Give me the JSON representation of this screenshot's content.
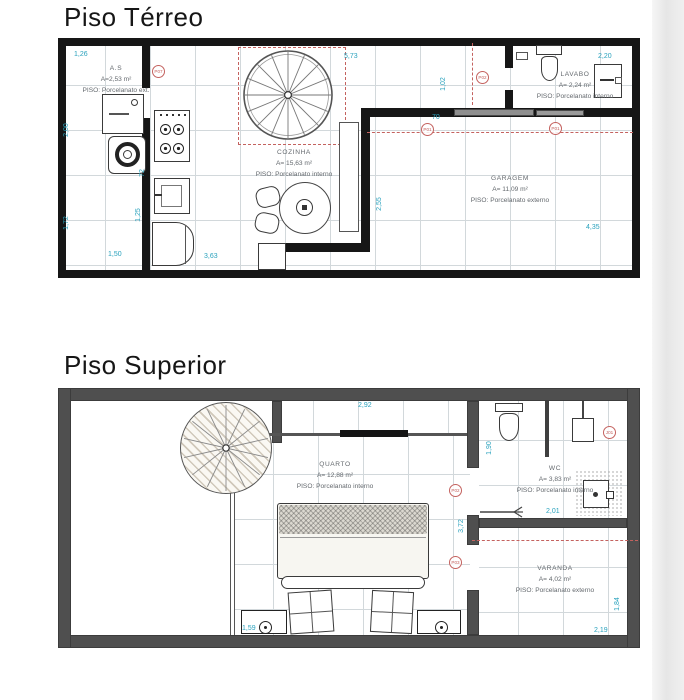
{
  "floors": {
    "terreo": {
      "title": "Piso Térreo",
      "rooms": {
        "as": {
          "name": "A.S",
          "area": "A=2,53 m²",
          "piso": "PISO: Porcelanato ext."
        },
        "cozinha": {
          "name": "COZINHA",
          "area": "A= 15,63 m²",
          "piso": "PISO: Porcelanato interno"
        },
        "lavabo": {
          "name": "LAVABO",
          "area": "A= 2,24 m²",
          "piso": "PISO: Porcelanato interno"
        },
        "garagem": {
          "name": "GARAGEM",
          "area": "A= 11,09 m²",
          "piso": "PISO: Porcelanato externo"
        }
      },
      "dims": {
        "d126": "1,26",
        "d200": "2,00",
        "d72": "72",
        "d172": "1,72",
        "d125": "1,25",
        "d150": "1,50",
        "d573": "5,73",
        "d70": "70",
        "d102": "1,02",
        "d220": "2,20",
        "d255": "2,55",
        "d435": "4,35",
        "d363": "3,63"
      },
      "tags": {
        "p07": "P07",
        "p02": "P02",
        "p01a": "P01",
        "p01b": "P01"
      }
    },
    "superior": {
      "title": "Piso Superior",
      "rooms": {
        "quarto": {
          "name": "QUARTO",
          "area": "A= 12,88 m²",
          "piso": "PISO: Porcelanato interno"
        },
        "wc": {
          "name": "WC",
          "area": "A= 3,83 m²",
          "piso": "PISO: Porcelanato interno"
        },
        "varanda": {
          "name": "VARANDA",
          "area": "A= 4,02 m²",
          "piso": "PISO: Porcelanato externo"
        }
      },
      "dims": {
        "d292": "2,92",
        "d190": "1,90",
        "d201": "2,01",
        "d372": "3,72",
        "d159": "1,59",
        "d184": "1,84",
        "d219": "2,19"
      },
      "tags": {
        "j01": "J01",
        "p02": "P02",
        "p03": "P03"
      }
    }
  },
  "colors": {
    "dimension_text": "#2aa2bd",
    "tag_red": "#c4625f",
    "wall_ground": "#161616",
    "wall_upper": "#4f4f4f",
    "grid_line": "#d2d8db"
  }
}
